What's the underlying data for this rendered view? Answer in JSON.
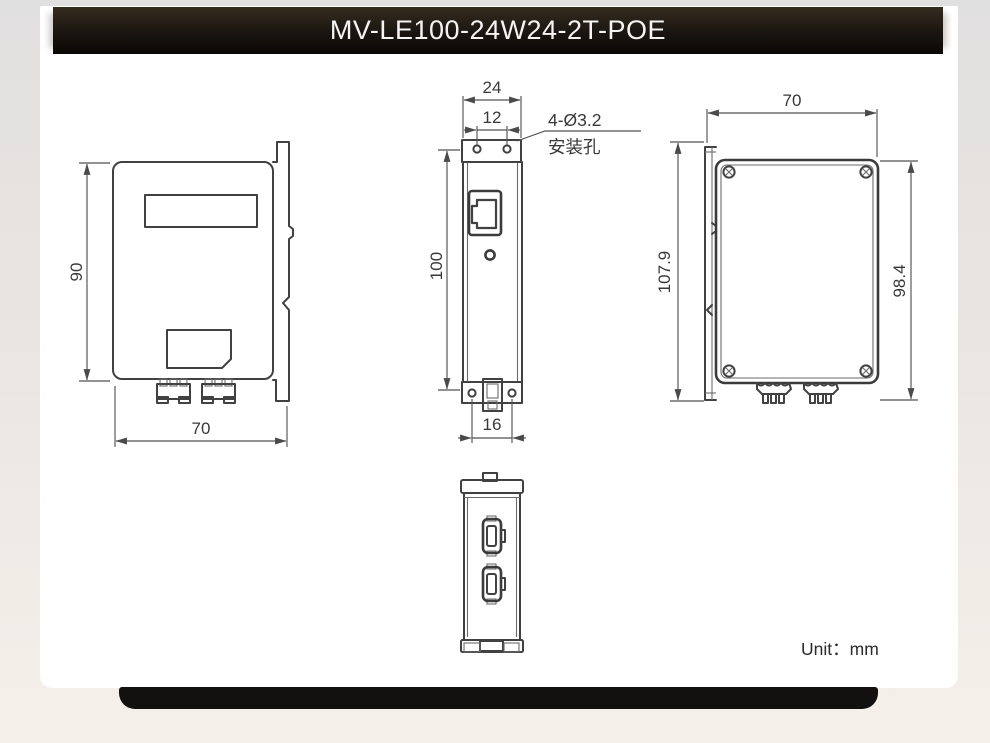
{
  "header": {
    "title": "MV-LE100-24W24-2T-POE"
  },
  "footer": {
    "unit_label": "Unit：mm"
  },
  "drawing": {
    "side_left": {
      "dim_height": "90",
      "dim_width": "70"
    },
    "front": {
      "dim_width": "24",
      "dim_hole_spacing": "12",
      "dim_height": "100",
      "dim_clip": "16",
      "callout_line1": "4-Ø3.2",
      "callout_line2": "安装孔"
    },
    "side_right": {
      "dim_width": "70",
      "dim_total_height": "107.9",
      "dim_body_height": "98.4"
    }
  }
}
